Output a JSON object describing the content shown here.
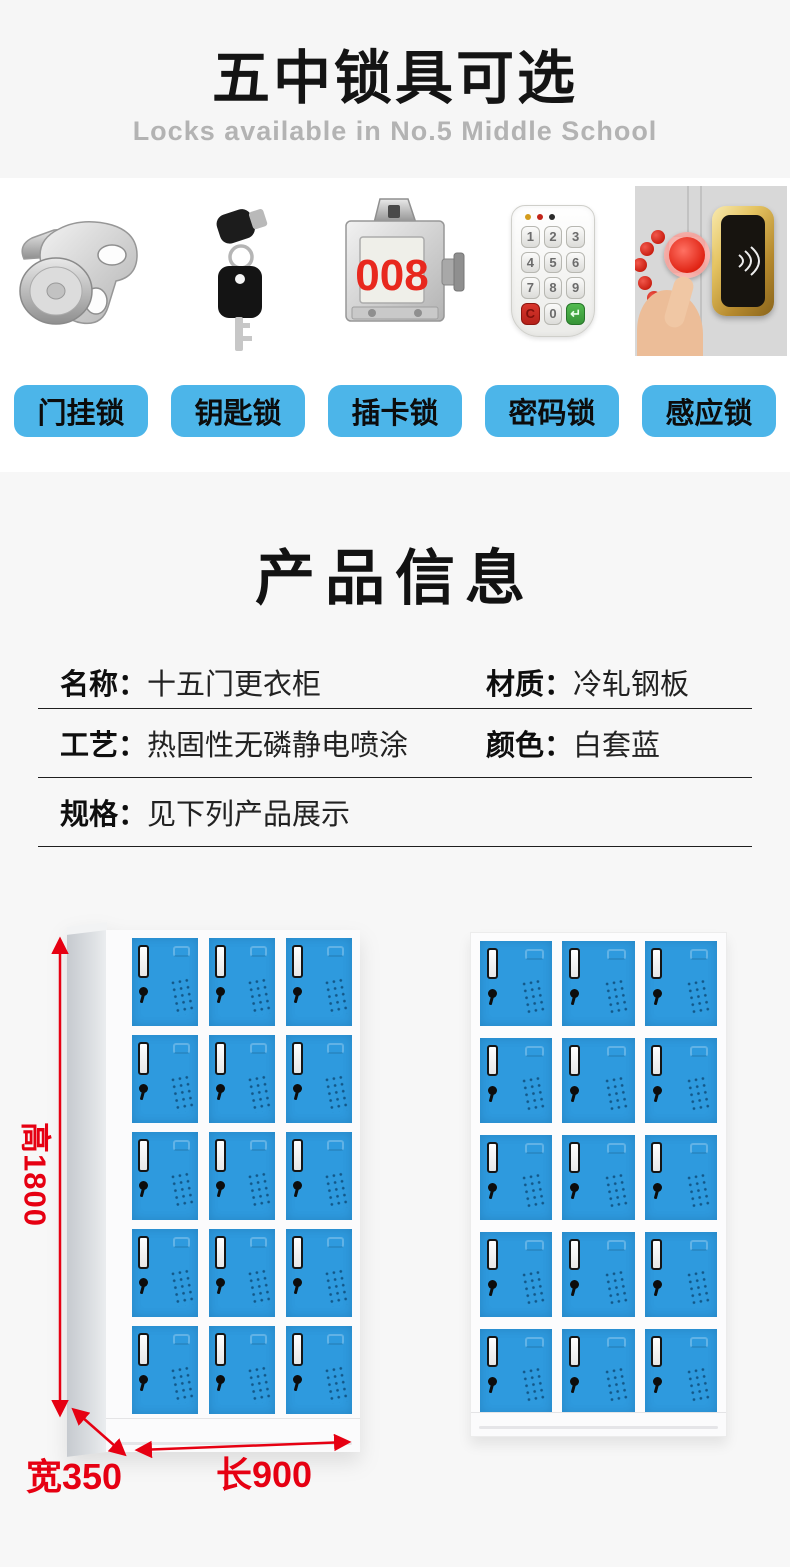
{
  "hero": {
    "title": "五中锁具可选",
    "subtitle": "Locks available in No.5 Middle School"
  },
  "locks": {
    "items": [
      {
        "label": "门挂锁",
        "icon": "hasp-lock-icon"
      },
      {
        "label": "钥匙锁",
        "icon": "key-lock-icon"
      },
      {
        "label": "插卡锁",
        "icon": "card-lock-icon",
        "display_number": "008"
      },
      {
        "label": "密码锁",
        "icon": "keypad-lock-icon",
        "keypad_keys": [
          "1",
          "2",
          "3",
          "4",
          "5",
          "6",
          "7",
          "8",
          "9",
          "C",
          "0",
          "↵"
        ]
      },
      {
        "label": "感应锁",
        "icon": "rfid-lock-icon"
      }
    ]
  },
  "product_info": {
    "title": "产品信息",
    "rows": [
      {
        "cells": [
          {
            "label": "名称：",
            "value": "十五门更衣柜"
          },
          {
            "label": "材质：",
            "value": "冷轧钢板"
          }
        ]
      },
      {
        "cells": [
          {
            "label": "工艺：",
            "value": "热固性无磷静电喷涂"
          },
          {
            "label": "颜色：",
            "value": "白套蓝"
          }
        ]
      },
      {
        "cells": [
          {
            "label": "规格：",
            "value": "见下列产品展示"
          }
        ]
      }
    ]
  },
  "lockers": {
    "rows": 5,
    "cols": 3,
    "dimensions": {
      "height": "高1800",
      "width": "宽350",
      "length": "长900"
    }
  },
  "colors": {
    "button_blue": "#4cb5e9",
    "door_blue": "#2e9ade",
    "dimension_red": "#e60012",
    "card_number_red": "#e8281e"
  }
}
